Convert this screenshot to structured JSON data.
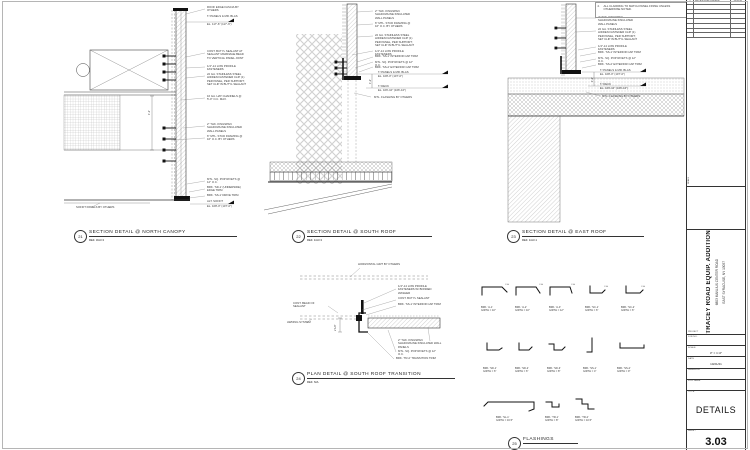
{
  "note": {
    "num": "2.",
    "text": "ALL CLADDING TO MATCH PANEL FINISH UNLESS OTHERWISE NOTED."
  },
  "dims": {
    "d21": "1'-2\"",
    "d22": "1'-2\"",
    "d23": "1'-2\"",
    "d24": "2 1/2\""
  },
  "details": {
    "d21": {
      "num": "21",
      "title": "SECTION DETAIL @ NORTH CANOPY",
      "ref": "REF. 3/A3.3",
      "ann": [
        "ROOF EDGE FASCIA BY OTHERS",
        "T/ PANELS & MR. BLAS",
        "EL. 117'-6\" (117'-6\")",
        "CONT. BUTYL SEALANT AT SEALANT MARRIAGE BEAD TO VERTICAL PANEL JOINT",
        "1/4\"-14 LOW PROFILE FASTENERS",
        "22 GA. STAINLESS STEEL HIDDEN FASTENER CLIP (1) PER PANEL, PER SUPPORT; SET CLIP IN BUTYL SEALANT",
        "16 GA. HAT CHANNELS @ 5'-0\" O.C. MAX.",
        "2\" THK. KINGSPAN SHADOWLINE INSULATED WALL PANELS",
        "6\" MTL. STUD FRAMING @ 16\" O.C. BY OTHERS",
        "MTL. SQ. POP RIVETS @ 12\" O.C.",
        "BRK. 'SD-1' (UNDERSIDE) EDGE TRIM",
        "BRK. 'SS-1' DRIVE TRIM",
        "ALT. SOFFIT",
        "EL. 108'-0\" (107'-0\")",
        "SOFFIT PANELS BY OTHERS"
      ]
    },
    "d22": {
      "num": "22",
      "title": "SECTION DETAIL @ SOUTH ROOF",
      "ref": "REF. 1/A3.3",
      "ann": [
        "2\" THK. KINGSPAN SHADOWLINE INSULATED WALL PANELS",
        "6\" MTL. STUD FRAMING @ 16\" O.C. BY OTHERS",
        "22 GA. STAINLESS STEEL HIDDEN FASTENER CLIP (1) PER PANEL, PER SUPPORT; SET CLIP IN BUTYL SEALANT",
        "1/4\"-14 LOW PROFILE FASTENERS",
        "BRK. 'SS-1' INTERIOR CAP TRIM",
        "MTL. SQ. POP RIVETS @ 12\" O.C.",
        "BRK. 'SS-2' EXTERIOR CAP TRIM",
        "T/ PANELS & MR. BLAS",
        "EL. 108'-0\" (107'-0\")",
        "T/ DECK",
        "EL. 106'-10\" (106'-10\")",
        "MTL. FLASHING BY OTHERS"
      ]
    },
    "d23": {
      "num": "23",
      "title": "SECTION DETAIL @ EAST ROOF",
      "ref": "REF. 1/A3.1",
      "ann": [
        "2\" THK. KINGSPAN SHADOWLINE INSULATED WALL PANELS",
        "22 GA. STAINLESS STEEL HIDDEN FASTENER CLIP (1) PER PANEL, PER SUPPORT; SET CLIP IN BUTYL SEALANT",
        "1/4\"-14 LOW PROFILE FASTENERS",
        "BRK. 'SS-1' INTERIOR CAP TRIM",
        "MTL. SQ. POP RIVETS @ 12\" O.C.",
        "BRK. 'SS-2' EXTERIOR CAP TRIM",
        "T/ PANELS & MR. BLAS",
        "EL. 108'-0\" (107'-0\")",
        "T/ DECK",
        "EL. 106'-10\" (106'-10\")",
        "MTL. FLASHING BY OTHERS"
      ]
    },
    "d24": {
      "num": "24",
      "title": "PLAN DETAIL @ SOUTH ROOF TRANSITION",
      "ref": "REF. N/A",
      "ann": [
        "HORIZONTAL GIRT BY OTHERS",
        "1/4\"-14 LOW PROFILE FASTENERS W/ BONDED WASHER",
        "CONT. BUTYL SEALANT",
        "BRK. 'SS-1' INTERIOR CAP TRIM",
        "CONT. BEAD OF SEALANT",
        "AWNING SYSTEM",
        "2\" THK. KINGSPAN SHADOWLINE INSULATED WALL PANELS",
        "MTL. SQ. POP RIVETS @ 12\" O.C.",
        "BRK. 'TR-2' TRANSITION TRIM"
      ]
    },
    "d25": {
      "num": "25",
      "title": "FLASHINGS"
    }
  },
  "flash_ca": "C.A.",
  "flashings": [
    {
      "name": "BRK. 'A-1'",
      "girth": "GIRTH = 10\""
    },
    {
      "name": "BRK. 'A-2'",
      "girth": "GIRTH = 10\""
    },
    {
      "name": "BRK. 'A-3'",
      "girth": "GIRTH = 12\""
    },
    {
      "name": "BRK. 'SC-1'",
      "girth": "GIRTH = 6\""
    },
    {
      "name": "BRK. 'SC-2'",
      "girth": "GIRTH = 6\""
    },
    {
      "name": "BRK. 'SD-1'",
      "girth": "GIRTH = 6\""
    },
    {
      "name": "BRK. 'SD-2'",
      "girth": "GIRTH = 6\""
    },
    {
      "name": "BRK. 'SD-3'",
      "girth": "GIRTH = 8\""
    },
    {
      "name": "BRK. 'SS-1'",
      "girth": "GIRTH = 4\""
    },
    {
      "name": "BRK. 'SS-2'",
      "girth": "GIRTH = 9\""
    },
    {
      "name": "BRK. 'SL-1'",
      "girth": "GIRTH = 16.5\""
    },
    {
      "name": "BRK. 'TR-1'",
      "girth": "GIRTH = 8\""
    },
    {
      "name": "BRK. 'TR-2'",
      "girth": "GIRTH = 10.5\""
    }
  ],
  "titleblock": {
    "revision": {
      "no": "1",
      "desc": "ISSUED FOR CONSTR.",
      "date": "10/21/21"
    },
    "seal_label": "SEALS",
    "project_label": "PROJECT",
    "project_name": "TRACEY ROAD EQUIP. ADDITION",
    "address1": "6803 MANLIUS CENTER ROAD",
    "address2": "EAST SYRACUSE, NY 13057",
    "fields": [
      {
        "label": "JOB NO.",
        "value": ""
      },
      {
        "label": "SCALE",
        "value": "3\" = 1'-0\""
      },
      {
        "label": "DATE",
        "value": "10/21/21"
      },
      {
        "label": "DRAWN BY",
        "value": ""
      },
      {
        "label": "FILE NAME",
        "value": ""
      }
    ],
    "title_label": "TITLE",
    "sheet_title": "DETAILS",
    "sheet_label": "SHEET",
    "sheet_number": "3.03"
  }
}
